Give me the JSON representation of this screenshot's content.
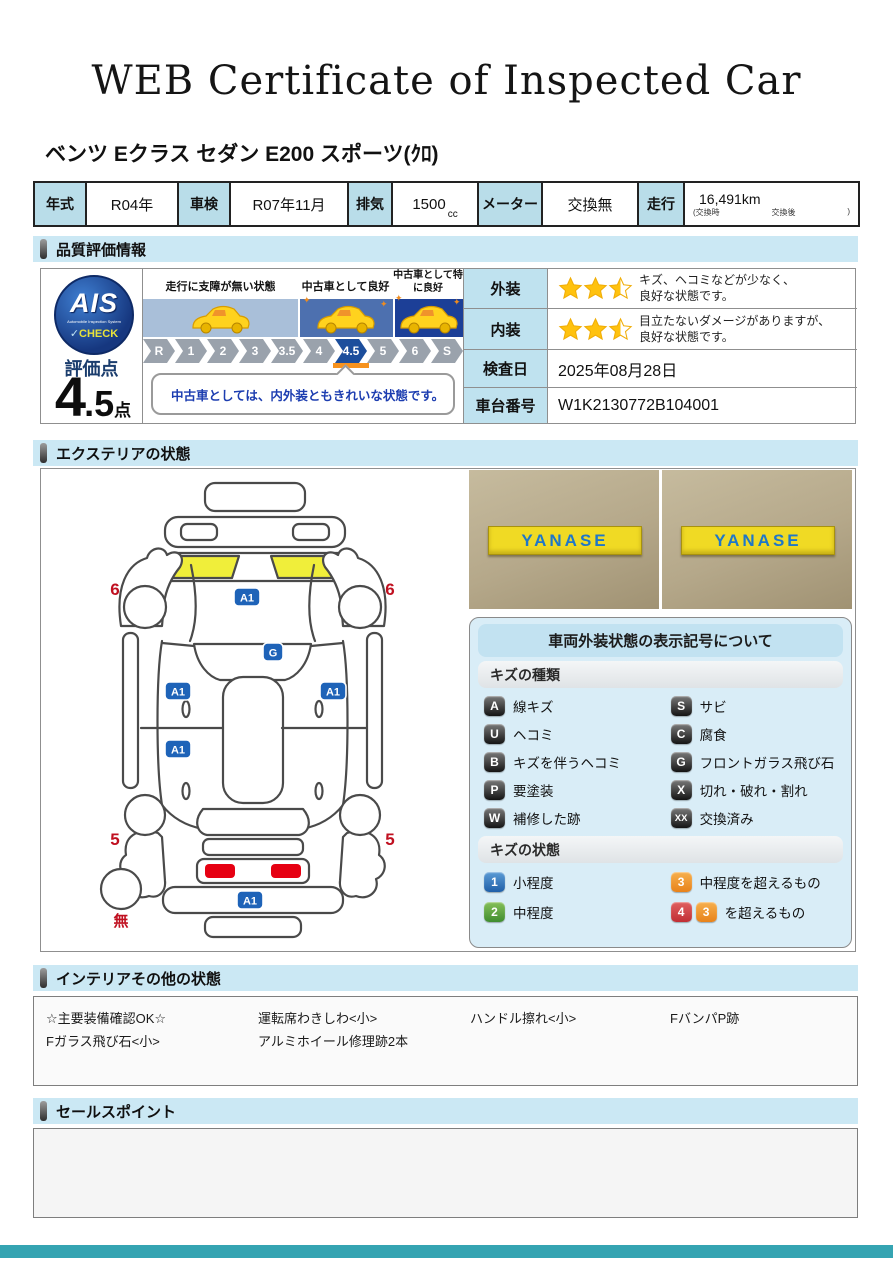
{
  "page": {
    "title": "WEB Certificate of Inspected Car",
    "subtitle": "ベンツ Eクラス セダン E200 スポーツ(ｸﾛ)",
    "footer_color": "#35a4b2"
  },
  "spec": {
    "year_label": "年式",
    "year": "R04年",
    "shaken_label": "車検",
    "shaken": "R07年11月",
    "displacement_label": "排気",
    "displacement": "1500",
    "displacement_unit": "cc",
    "meter_label": "メーター",
    "meter": "交換無",
    "mileage_label": "走行",
    "mileage": "16,491km",
    "mileage_sub_left": "(交換時",
    "mileage_sub_mid": "交換後",
    "mileage_sub_right": ")"
  },
  "quality": {
    "section_title": "品質評価情報",
    "logo": {
      "text": "AIS",
      "subtext": "Automobile Inspection System",
      "check": "CHECK"
    },
    "score_label": "評価点",
    "score_main": "4",
    "score_dec": ".5",
    "score_unit": "点",
    "zone_captions": [
      "走行に支障が無い状態",
      "中古車として良好",
      "中古車として特に良好"
    ],
    "scale": [
      "R",
      "1",
      "2",
      "3",
      "3.5",
      "4",
      "4.5",
      "5",
      "6",
      "S"
    ],
    "scale_active": "4.5",
    "comment": "中古車としては、内外装ともきれいな状態です。",
    "exterior_label": "外装",
    "exterior_stars": 2.5,
    "exterior_lines": [
      "キズ、ヘコミなどが少なく、",
      "良好な状態です。"
    ],
    "interior_label": "内装",
    "interior_stars": 2.5,
    "interior_lines": [
      "目立たないダメージがありますが、",
      "良好な状態です。"
    ],
    "date_label": "検査日",
    "date": "2025年08月28日",
    "vin_label": "車台番号",
    "vin": "W1K2130772B104001",
    "star_color": "#FFC20E"
  },
  "exterior": {
    "section_title": "エクステリアの状態",
    "photo_sign": "YANASE",
    "badge_color": "#1e63b8",
    "count_color": "#c01020",
    "highlight_color": "#f0ee3a",
    "taillight_color": "#e60012",
    "markers": [
      {
        "label": "A1",
        "type": "badge",
        "x": 202,
        "y": 126
      },
      {
        "label": "G",
        "type": "badge",
        "x": 228,
        "y": 181
      },
      {
        "label": "A1",
        "type": "badge",
        "x": 133,
        "y": 220
      },
      {
        "label": "A1",
        "type": "badge",
        "x": 288,
        "y": 220
      },
      {
        "label": "A1",
        "type": "badge",
        "x": 133,
        "y": 278
      },
      {
        "label": "A1",
        "type": "badge",
        "x": 205,
        "y": 429
      },
      {
        "label": "6",
        "type": "count",
        "x": 70,
        "y": 124
      },
      {
        "label": "6",
        "type": "count",
        "x": 345,
        "y": 124
      },
      {
        "label": "5",
        "type": "count",
        "x": 70,
        "y": 374
      },
      {
        "label": "5",
        "type": "count",
        "x": 345,
        "y": 374
      },
      {
        "label": "無",
        "type": "count",
        "x": 76,
        "y": 455
      }
    ]
  },
  "legend": {
    "title": "車両外装状態の表示記号について",
    "kinds_header": "キズの種類",
    "kinds": [
      {
        "code": "A",
        "label": "線キズ"
      },
      {
        "code": "S",
        "label": "サビ"
      },
      {
        "code": "U",
        "label": "ヘコミ"
      },
      {
        "code": "C",
        "label": "腐食"
      },
      {
        "code": "B",
        "label": "キズを伴うヘコミ"
      },
      {
        "code": "G",
        "label": "フロントガラス飛び石"
      },
      {
        "code": "P",
        "label": "要塗装"
      },
      {
        "code": "X",
        "label": "切れ・破れ・割れ"
      },
      {
        "code": "W",
        "label": "補修した跡"
      },
      {
        "code": "XX",
        "label": "交換済み"
      }
    ],
    "states_header": "キズの状態",
    "states": [
      {
        "badges": [
          {
            "text": "1",
            "color": "blue"
          }
        ],
        "label": "小程度"
      },
      {
        "badges": [
          {
            "text": "3",
            "color": "orange"
          }
        ],
        "label": "中程度を超えるもの"
      },
      {
        "badges": [
          {
            "text": "2",
            "color": "green"
          }
        ],
        "label": "中程度"
      },
      {
        "badges": [
          {
            "text": "4",
            "color": "red"
          },
          {
            "text": "3",
            "color": "orange"
          }
        ],
        "label": "を超えるもの"
      }
    ]
  },
  "interior": {
    "section_title": "インテリアその他の状態",
    "items": [
      "☆主要装備確認OK☆",
      "運転席わきしわ<小>",
      "ハンドル擦れ<小>",
      "FバンパP跡",
      "Fガラス飛び石<小>",
      "アルミホイール修理跡2本"
    ]
  },
  "sales": {
    "section_title": "セールスポイント",
    "content": ""
  }
}
